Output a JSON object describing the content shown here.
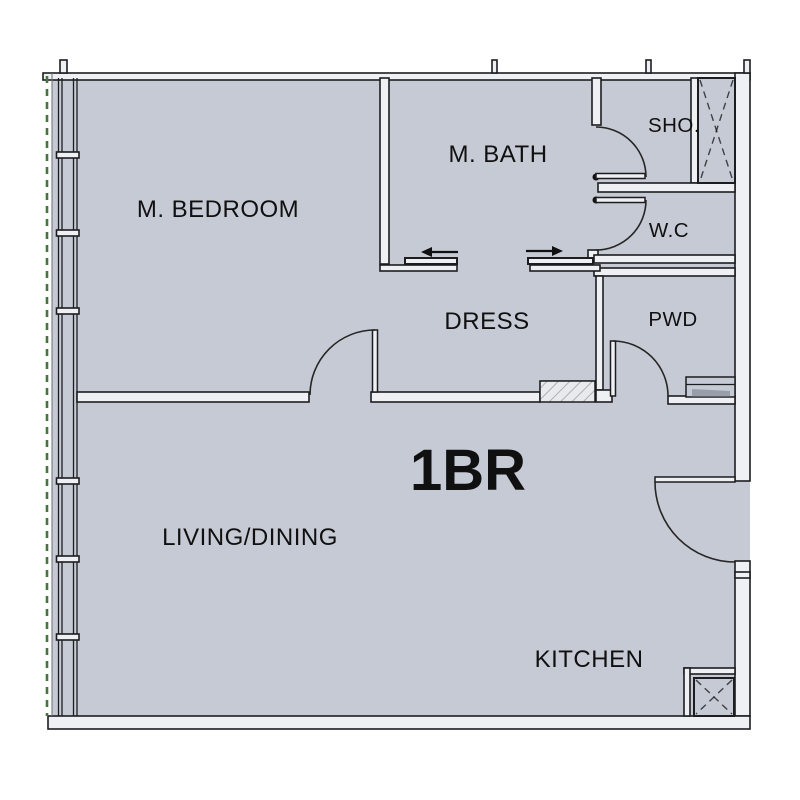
{
  "unit": {
    "type_label": "1BR"
  },
  "rooms": {
    "m_bedroom": {
      "label": "M. BEDROOM"
    },
    "m_bath": {
      "label": "M. BATH"
    },
    "shower": {
      "label": "SHO."
    },
    "wc": {
      "label": "W.C"
    },
    "dress": {
      "label": "DRESS"
    },
    "powder": {
      "label": "PWD"
    },
    "living_dining": {
      "label": "LIVING/DINING"
    },
    "kitchen": {
      "label": "KITCHEN"
    }
  },
  "colors": {
    "floor": "#c6cad5",
    "wall_line": "#1d1d1f",
    "wall_fill": "#eef0f4",
    "accent_green": "#47753f",
    "hatch_gray": "#aab0b8",
    "shadow_gray": "#999ea8",
    "thin_line": "#6a6d73",
    "label_ink": "#101010"
  }
}
